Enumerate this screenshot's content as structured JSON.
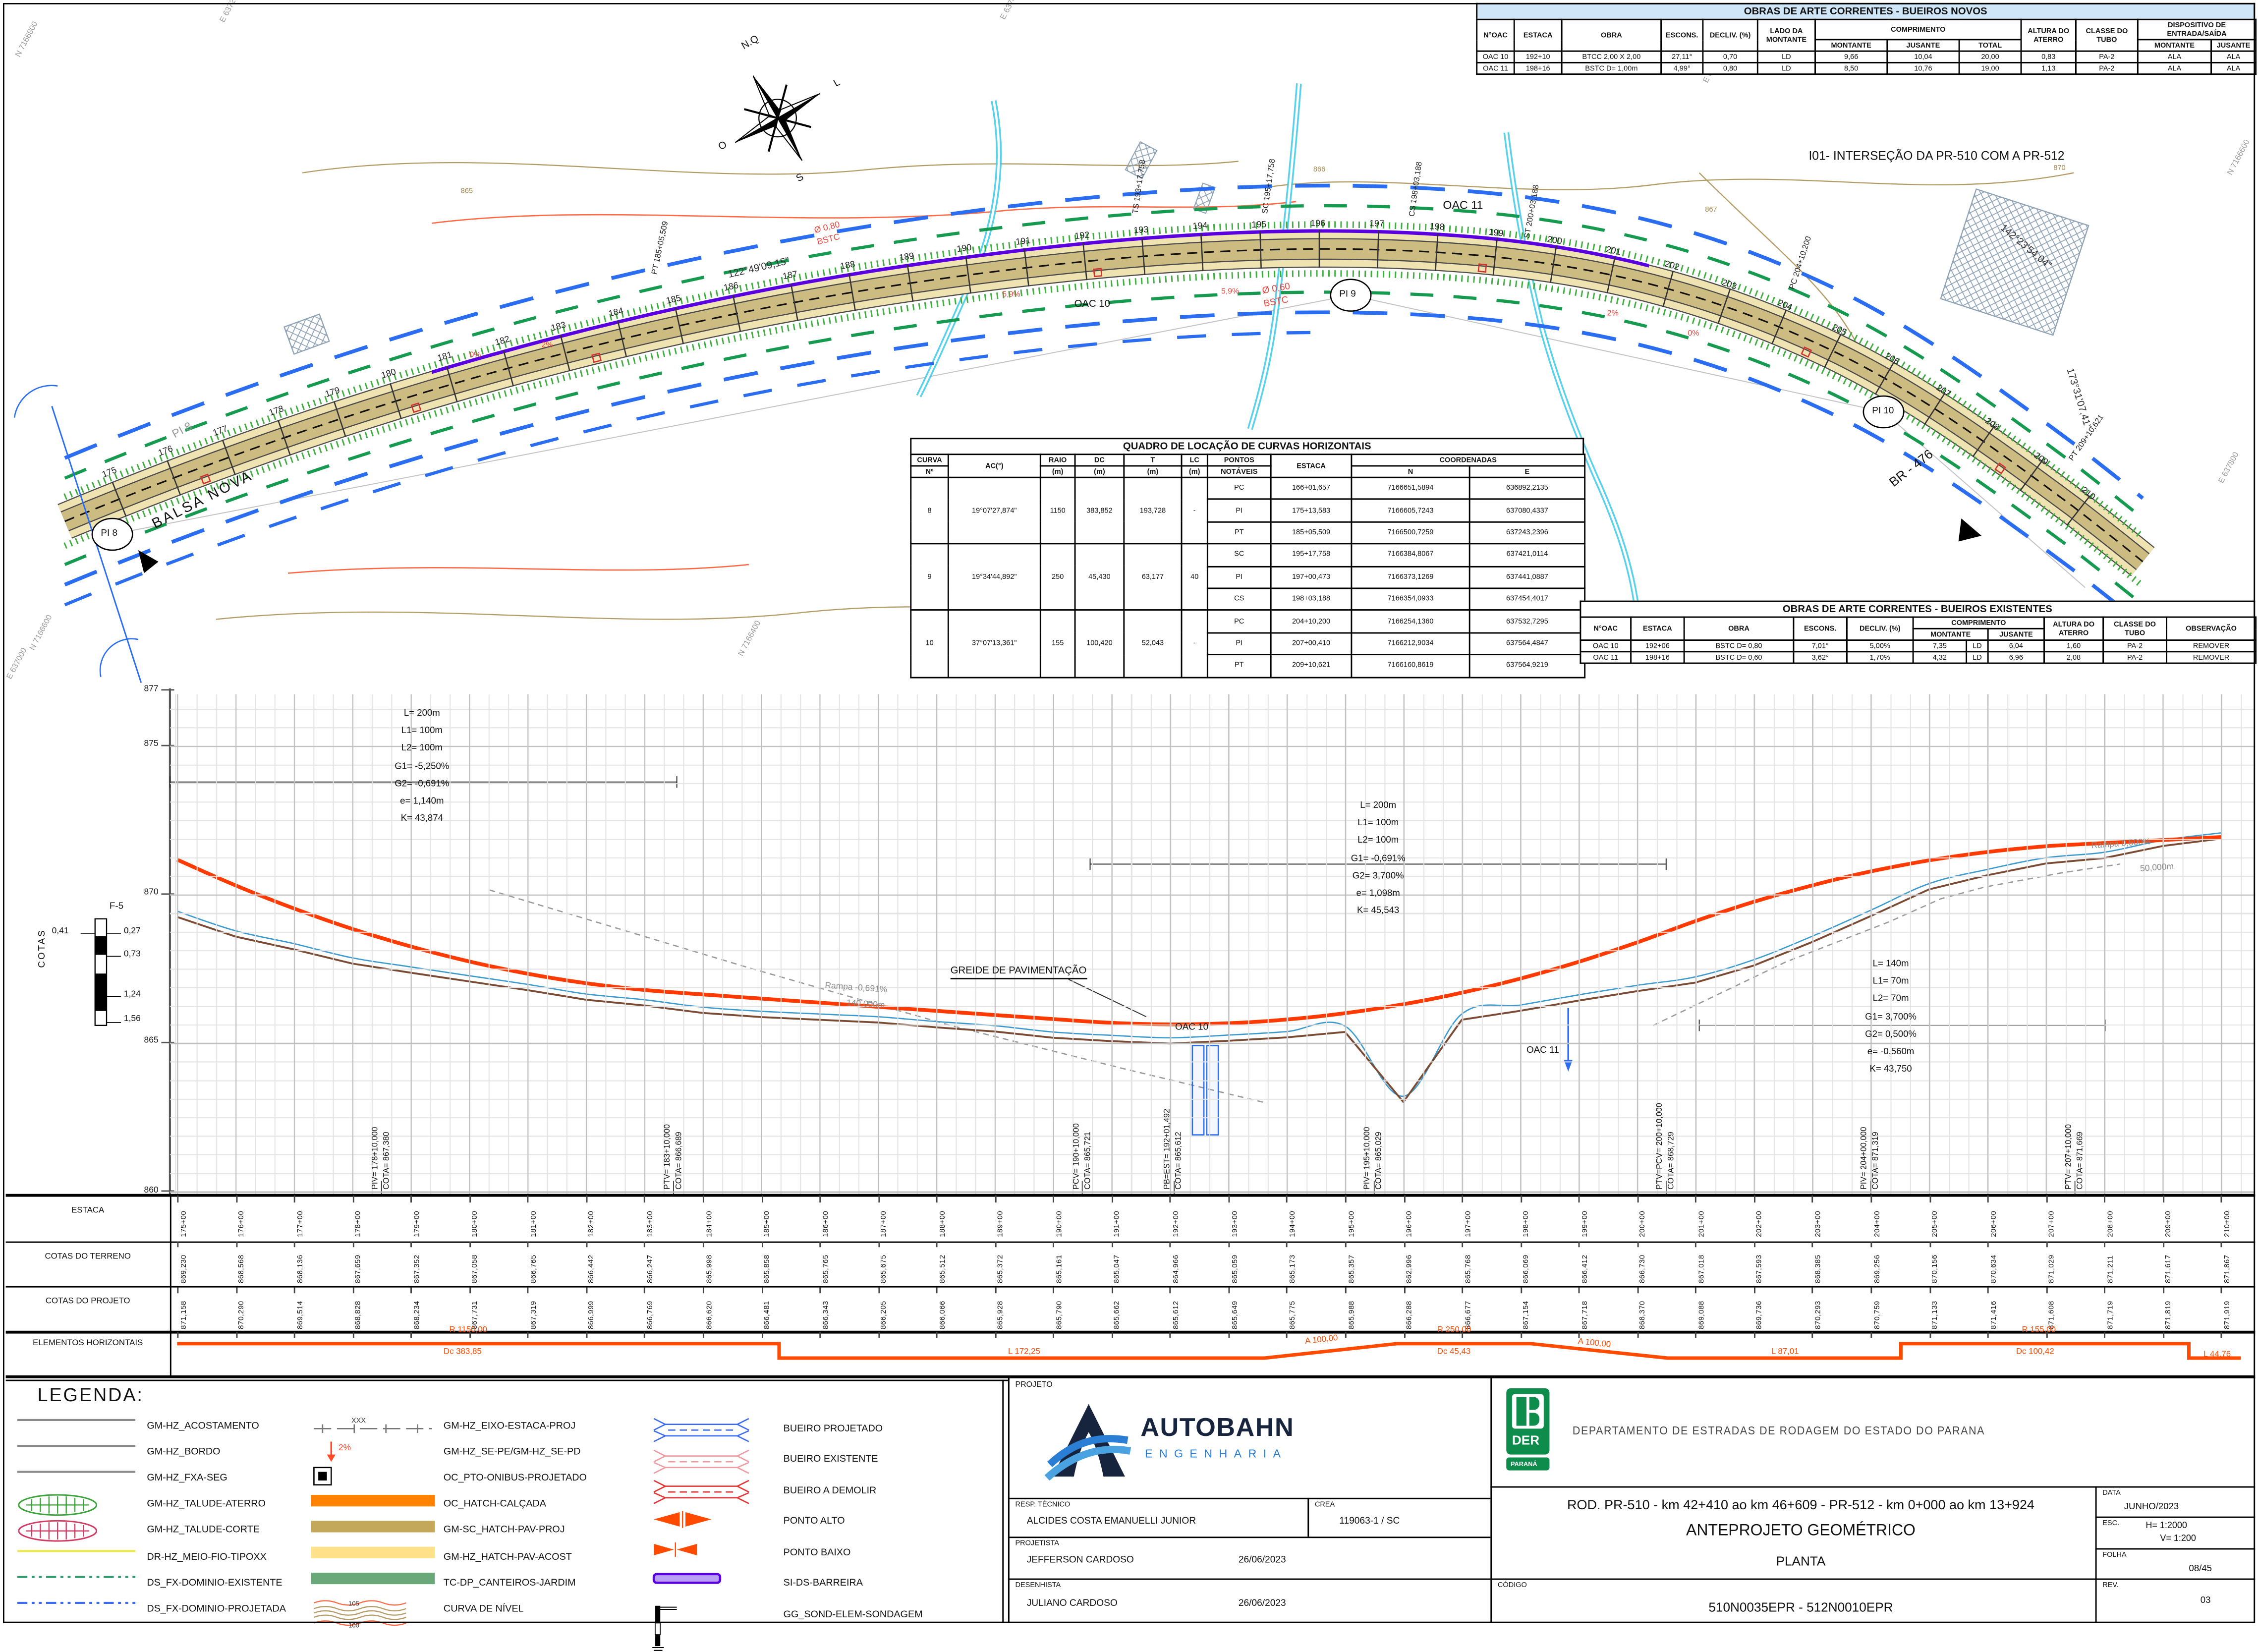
{
  "novos_table": {
    "title": "OBRAS DE ARTE CORRENTES - BUEIROS NOVOS",
    "headers": {
      "noac": "N°OAC",
      "estaca": "ESTACA",
      "obra": "OBRA",
      "escons": "ESCONS.",
      "decliv": "DECLIV. (%)",
      "lado": "LADO DA MONTANTE",
      "comprimento": "COMPRIMENTO",
      "montante": "MONTANTE",
      "jusante": "JUSANTE",
      "total": "TOTAL",
      "altura": "ALTURA DO ATERRO",
      "classe": "CLASSE DO TUBO",
      "dispositivo": "DISPOSITIVO DE ENTRADA/SAÍDA",
      "disp_montante": "MONTANTE",
      "disp_jusante": "JUSANTE"
    },
    "rows": [
      [
        "OAC 10",
        "192+10",
        "BTCC 2,00 X 2,00",
        "27,11°",
        "0,70",
        "LD",
        "9,66",
        "10,04",
        "20,00",
        "0,83",
        "PA-2",
        "ALA",
        "ALA"
      ],
      [
        "OAC 11",
        "198+16",
        "BSTC D= 1,00m",
        "4,99°",
        "0,80",
        "LD",
        "8,50",
        "10,76",
        "19,00",
        "1,13",
        "PA-2",
        "ALA",
        "ALA"
      ]
    ]
  },
  "curvas_table": {
    "title": "QUADRO DE LOCAÇÃO DE CURVAS HORIZONTAIS",
    "headers": {
      "curva": "CURVA",
      "num": "Nº",
      "ac": "AC(°)",
      "raio": "RAIO",
      "dc": "DC",
      "t": "T",
      "lc": "LC",
      "m": "(m)",
      "pontos": "PONTOS",
      "notaveis": "NOTÁVEIS",
      "estaca": "ESTACA",
      "coordenadas": "COORDENADAS",
      "n": "N",
      "e": "E"
    },
    "curves": [
      {
        "n": "8",
        "ac": "19°07'27,874\"",
        "raio": "1150",
        "dc": "383,852",
        "t": "193,728",
        "lc": "-",
        "pts": [
          [
            "PC",
            "166+01,657",
            "7166651,5894",
            "636892,2135"
          ],
          [
            "PI",
            "175+13,583",
            "7166605,7243",
            "637080,4337"
          ],
          [
            "PT",
            "185+05,509",
            "7166500,7259",
            "637243,2396"
          ]
        ]
      },
      {
        "n": "9",
        "ac": "19°34'44,892\"",
        "raio": "250",
        "dc": "45,430",
        "t": "63,177",
        "lc": "40",
        "pts": [
          [
            "SC",
            "195+17,758",
            "7166384,8067",
            "637421,0114"
          ],
          [
            "PI",
            "197+00,473",
            "7166373,1269",
            "637441,0887"
          ],
          [
            "CS",
            "198+03,188",
            "7166354,0933",
            "637454,4017"
          ]
        ]
      },
      {
        "n": "10",
        "ac": "37°07'13,361\"",
        "raio": "155",
        "dc": "100,420",
        "t": "52,043",
        "lc": "-",
        "pts": [
          [
            "PC",
            "204+10,200",
            "7166254,1360",
            "637532,7295"
          ],
          [
            "PI",
            "207+00,410",
            "7166212,9034",
            "637564,4847"
          ],
          [
            "PT",
            "209+10,621",
            "7166160,8619",
            "637564,9219"
          ]
        ]
      }
    ]
  },
  "existentes_table": {
    "title": "OBRAS DE ARTE CORRENTES - BUEIROS EXISTENTES",
    "headers": {
      "noac": "N°OAC",
      "estaca": "ESTACA",
      "obra": "OBRA",
      "escons": "ESCONS.",
      "decliv": "DECLIV. (%)",
      "comprimento": "COMPRIMENTO",
      "montante": "MONTANTE",
      "jusante": "JUSANTE",
      "altura": "ALTURA DO ATERRO",
      "classe": "CLASSE DO TUBO",
      "observacao": "OBSERVAÇÃO"
    },
    "rows": [
      [
        "OAC 10",
        "192+06",
        "BSTC D= 0,80",
        "7,01°",
        "5,00%",
        "7,35",
        "LD",
        "6,04",
        "1,60",
        "PA-2",
        "REMOVER"
      ],
      [
        "OAC 11",
        "198+16",
        "BSTC D= 0,60",
        "3,62°",
        "1,70%",
        "4,32",
        "LD",
        "6,96",
        "2,08",
        "PA-2",
        "REMOVER"
      ]
    ]
  },
  "plan": {
    "compass": {
      "n": "N.Q",
      "e": "L",
      "s": "S",
      "w": "O"
    },
    "pi_circles": [
      "PI 8",
      "PI 9",
      "PI 10"
    ],
    "annotations": [
      "I01- INTERSEÇÃO DA PR-510 COM A PR-512",
      "BALSA NOVA",
      "BR - 476",
      "OAC 10",
      "OAC 11",
      "122°49'09,15\"",
      "142°23'54,04\"",
      "173°31'07,41\"",
      "PT 185+05,509",
      "TS 193+17,758",
      "SC 195+17,758",
      "CS 198+03,188",
      "ST 200+03,188",
      "PC 204+10,200",
      "PT 209+10,621",
      "Ø 0,80",
      "BSTC",
      "Ø 0,60",
      "BSTC",
      "PI 8",
      "865",
      "866",
      "867",
      "870",
      "N 7166800",
      "E 637200",
      "E 637400",
      "E 637600",
      "E 637800",
      "N 7166600",
      "E 637000",
      "N 7166400",
      "N 7166600",
      "5,9%",
      "5,9%",
      "2%",
      "2%",
      "0%",
      "0%"
    ],
    "station_first": 175,
    "station_last": 210
  },
  "profile": {
    "axis_label": "COTAS",
    "ticks": [
      "877",
      "875",
      "870",
      "865",
      "860"
    ],
    "curve_notes": [
      {
        "lines": [
          "L= 200m",
          "L1= 100m",
          "L2= 100m",
          "G1= -5,250%",
          "G2= -0,691%",
          "e= 1,140m",
          "K= 43,874"
        ]
      },
      {
        "lines": [
          "L= 200m",
          "L1= 100m",
          "L2= 100m",
          "G1= -0,691%",
          "G2= 3,700%",
          "e= 1,098m",
          "K= 45,543"
        ]
      },
      {
        "lines": [
          "L= 140m",
          "L1= 70m",
          "L2= 70m",
          "G1= 3,700%",
          "G2= 0,500%",
          "e= -0,560m",
          "K= 43,750"
        ]
      }
    ],
    "vpi": [
      {
        "l1": "PIV= 178+10,000",
        "l2": "COTA= 867,380"
      },
      {
        "l1": "PTV= 183+10,000",
        "l2": "COTA= 866,689"
      },
      {
        "l1": "PCV= 190+10,000",
        "l2": "COTA= 865,721"
      },
      {
        "l1": "PB=EST= 192+01,492",
        "l2": "COTA= 865,612"
      },
      {
        "l1": "PIV= 195+10,000",
        "l2": "COTA= 865,029"
      },
      {
        "l1": "PTV=PCV= 200+10,000",
        "l2": "COTA= 868,729"
      },
      {
        "l1": "PIV= 204+00,000",
        "l2": "COTA= 871,319"
      },
      {
        "l1": "PTV= 207+10,000",
        "l2": "COTA= 871,669"
      }
    ],
    "labels": {
      "greide": "GREIDE DE PAVIMENTAÇÃO",
      "rampa1": "Rampa -0,691%",
      "rampa1_len": "140,000m",
      "rampa2": "Rampa 0,500%",
      "rampa2_len": "50,000m",
      "oac10": "OAC 10",
      "oac11": "OAC 11",
      "f5": "F-5",
      "f5_left": "0,41",
      "f5_depths": [
        "0,27",
        "0,73",
        "1,24",
        "1,56"
      ]
    }
  },
  "lower_table": {
    "row_headers": [
      "ESTACA",
      "COTAS DO TERRENO",
      "COTAS DO PROJETO",
      "ELEMENTOS HORIZONTAIS"
    ],
    "estacas": [
      "175+00",
      "176+00",
      "177+00",
      "178+00",
      "179+00",
      "180+00",
      "181+00",
      "182+00",
      "183+00",
      "184+00",
      "185+00",
      "186+00",
      "187+00",
      "188+00",
      "189+00",
      "190+00",
      "191+00",
      "192+00",
      "193+00",
      "194+00",
      "195+00",
      "196+00",
      "197+00",
      "198+00",
      "199+00",
      "200+00",
      "201+00",
      "202+00",
      "203+00",
      "204+00",
      "205+00",
      "206+00",
      "207+00",
      "208+00",
      "209+00",
      "210+00"
    ],
    "terreno": [
      "869,230",
      "868,568",
      "868,136",
      "867,659",
      "867,352",
      "867,058",
      "866,765",
      "866,442",
      "866,247",
      "865,998",
      "865,858",
      "865,765",
      "865,675",
      "865,512",
      "865,372",
      "865,161",
      "865,047",
      "864,966",
      "865,059",
      "865,173",
      "865,357",
      "862,996",
      "865,768",
      "866,069",
      "866,412",
      "866,730",
      "867,018",
      "867,593",
      "868,385",
      "869,256",
      "870,156",
      "870,634",
      "871,029",
      "871,211",
      "871,617",
      "871,867"
    ],
    "projeto": [
      "871,158",
      "870,290",
      "869,514",
      "868,828",
      "868,234",
      "867,731",
      "867,319",
      "866,999",
      "866,769",
      "866,620",
      "866,481",
      "866,343",
      "866,205",
      "866,066",
      "865,928",
      "865,790",
      "865,662",
      "865,612",
      "865,649",
      "865,775",
      "865,988",
      "866,288",
      "866,677",
      "867,154",
      "867,718",
      "868,370",
      "869,088",
      "869,736",
      "870,293",
      "870,759",
      "871,133",
      "871,416",
      "871,608",
      "871,719",
      "871,819",
      "871,919"
    ],
    "elementos_labels": [
      "R 1150,00",
      "Dc 383,85",
      "L 172,25",
      "A 100,00",
      "R 250,00",
      "Dc 45,43",
      "A 100,00",
      "L 87,01",
      "R 155,00",
      "Dc 100,42",
      "L 44,76"
    ]
  },
  "legend": {
    "title": "LEGENDA:",
    "col1": [
      {
        "sym": "line-gray",
        "label": "GM-HZ_ACOSTAMENTO"
      },
      {
        "sym": "line-gray",
        "label": "GM-HZ_BORDO"
      },
      {
        "sym": "line-gray",
        "label": "GM-HZ_FXA-SEG"
      },
      {
        "sym": "talude-green",
        "label": "GM-HZ_TALUDE-ATERRO"
      },
      {
        "sym": "talude-red",
        "label": "GM-HZ_TALUDE-CORTE"
      },
      {
        "sym": "line-yellow",
        "label": "DR-HZ_MEIO-FIO-TIPOXX"
      },
      {
        "sym": "dashdot-green",
        "label": "DS_FX-DOMINIO-EXISTENTE"
      },
      {
        "sym": "dashdot-blue",
        "label": "DS_FX-DOMINIO-PROJETADA"
      }
    ],
    "col2": [
      {
        "sym": "eixo",
        "label": "GM-HZ_EIXO-ESTACA-PROJ"
      },
      {
        "sym": "arrow2",
        "label": "GM-HZ_SE-PE/GM-HZ_SE-PD"
      },
      {
        "sym": "busstop",
        "label": "OC_PTO-ONIBUS-PROJETADO"
      },
      {
        "sym": "bar-orange",
        "label": "OC_HATCH-CALÇADA"
      },
      {
        "sym": "bar-khaki",
        "label": "GM-SC_HATCH-PAV-PROJ"
      },
      {
        "sym": "bar-yellow",
        "label": "GM-HZ_HATCH-PAV-ACOST"
      },
      {
        "sym": "bar-green",
        "label": "TC-DP_CANTEIROS-JARDIM"
      },
      {
        "sym": "curva-nivel",
        "label": "CURVA DE NÍVEL"
      }
    ],
    "col3": [
      {
        "sym": "culvert-blue",
        "label": "BUEIRO PROJETADO"
      },
      {
        "sym": "culvert-pink",
        "label": "BUEIRO EXISTENTE"
      },
      {
        "sym": "culvert-red",
        "label": "BUEIRO A DEMOLIR"
      },
      {
        "sym": "bowtie1",
        "label": "PONTO ALTO"
      },
      {
        "sym": "bowtie2",
        "label": "PONTO BAIXO"
      },
      {
        "sym": "barreira",
        "label": "SI-DS-BARREIRA"
      },
      {
        "sym": "sondagem",
        "label": "GG_SOND-ELEM-SONDAGEM"
      }
    ],
    "symbol_texts": {
      "xxx": "XXX",
      "pct": "2%",
      "c105": "105",
      "c100": "100"
    }
  },
  "title_block": {
    "projeto_label": "PROJETO",
    "logo_name": "AUTOBAHN",
    "logo_sub": "ENGENHARIA",
    "resp_label": "RESP. TÉCNICO",
    "resp": "ALCIDES COSTA EMANUELLI JUNIOR",
    "crea_label": "CREA",
    "crea": "119063-1 / SC",
    "projetista_label": "PROJETISTA",
    "projetista": "JEFFERSON CARDOSO",
    "date1": "26/06/2023",
    "desenhista_label": "DESENHISTA",
    "desenhista": "JULIANO CARDOSO",
    "date2": "26/06/2023",
    "der_sigla": "DER",
    "der_estado": "PARANÁ",
    "dept": "DEPARTAMENTO  DE  ESTRADAS  DE  RODAGEM  DO  ESTADO  DO  PARANA",
    "road": "ROD. PR-510 - km 42+410 ao km 46+609 - PR-512 - km 0+000 ao km 13+924",
    "doc_title": "ANTEPROJETO GEOMÉTRICO",
    "doc_sub": "PLANTA",
    "codigo_label": "CÓDIGO",
    "codigo": "510N0035EPR - 512N0010EPR",
    "data_label": "DATA",
    "data": "JUNHO/2023",
    "esc_label": "ESC.",
    "esc_h": "H= 1:2000",
    "esc_v": "V= 1:200",
    "folha_label": "FOLHA",
    "folha": "08/45",
    "rev_label": "REV.",
    "rev": "03"
  }
}
